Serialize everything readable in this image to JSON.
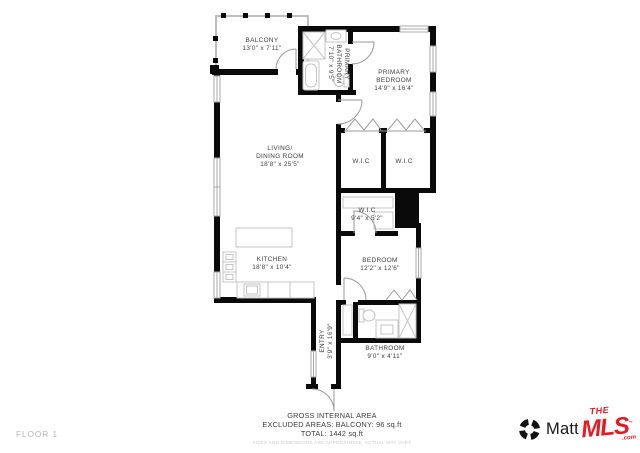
{
  "floor_label": "FLOOR 1",
  "rooms": {
    "balcony": {
      "name": "BALCONY",
      "dims": "13'0\" x 7'11\""
    },
    "primary_bathroom": {
      "name1": "PRIMARY",
      "name2": "BATHROOM",
      "dims": "7'10\" x 9'5\""
    },
    "primary_bedroom": {
      "name1": "PRIMARY",
      "name2": "BEDROOM",
      "dims": "14'9\" x 16'4\""
    },
    "living": {
      "name1": "LIVING/",
      "name2": "DINING ROOM",
      "dims": "18'8\" x 25'5\""
    },
    "wic1": {
      "name": "W.I.C"
    },
    "wic2": {
      "name": "W.I.C"
    },
    "wic3": {
      "name": "W.I.C",
      "dims": "9'4\" x 5'2\""
    },
    "kitchen": {
      "name": "KITCHEN",
      "dims": "18'8\" x 10'4\""
    },
    "bedroom": {
      "name": "BEDROOM",
      "dims": "12'2\" x 12'6\""
    },
    "entry": {
      "name": "ENTRY",
      "dims": "3'9\" x 16'9\""
    },
    "bathroom": {
      "name": "BATHROOM",
      "dims": "9'0\" x 4'11\""
    }
  },
  "summary": {
    "line1": "GROSS INTERNAL AREA",
    "line2": "EXCLUDED AREAS: BALCONY: 96 sq.ft",
    "line3": "TOTAL: 1442 sq.ft",
    "disclaimer": "SIZES AND DIMENSIONS ARE APPROXIMATE, ACTUAL MAY VARY"
  },
  "branding": {
    "matterport": "Matterport",
    "mls_the": "THE",
    "mls_main": "MLS",
    "mls_tm": "™",
    "mls_com": ".com"
  },
  "colors": {
    "wall": "#0a0a0a",
    "fixture_gray": "#c4c4c4",
    "label_gray": "#3c3c3c",
    "muted_gray": "#b5b5b5",
    "mls_red": "#e31b23"
  }
}
